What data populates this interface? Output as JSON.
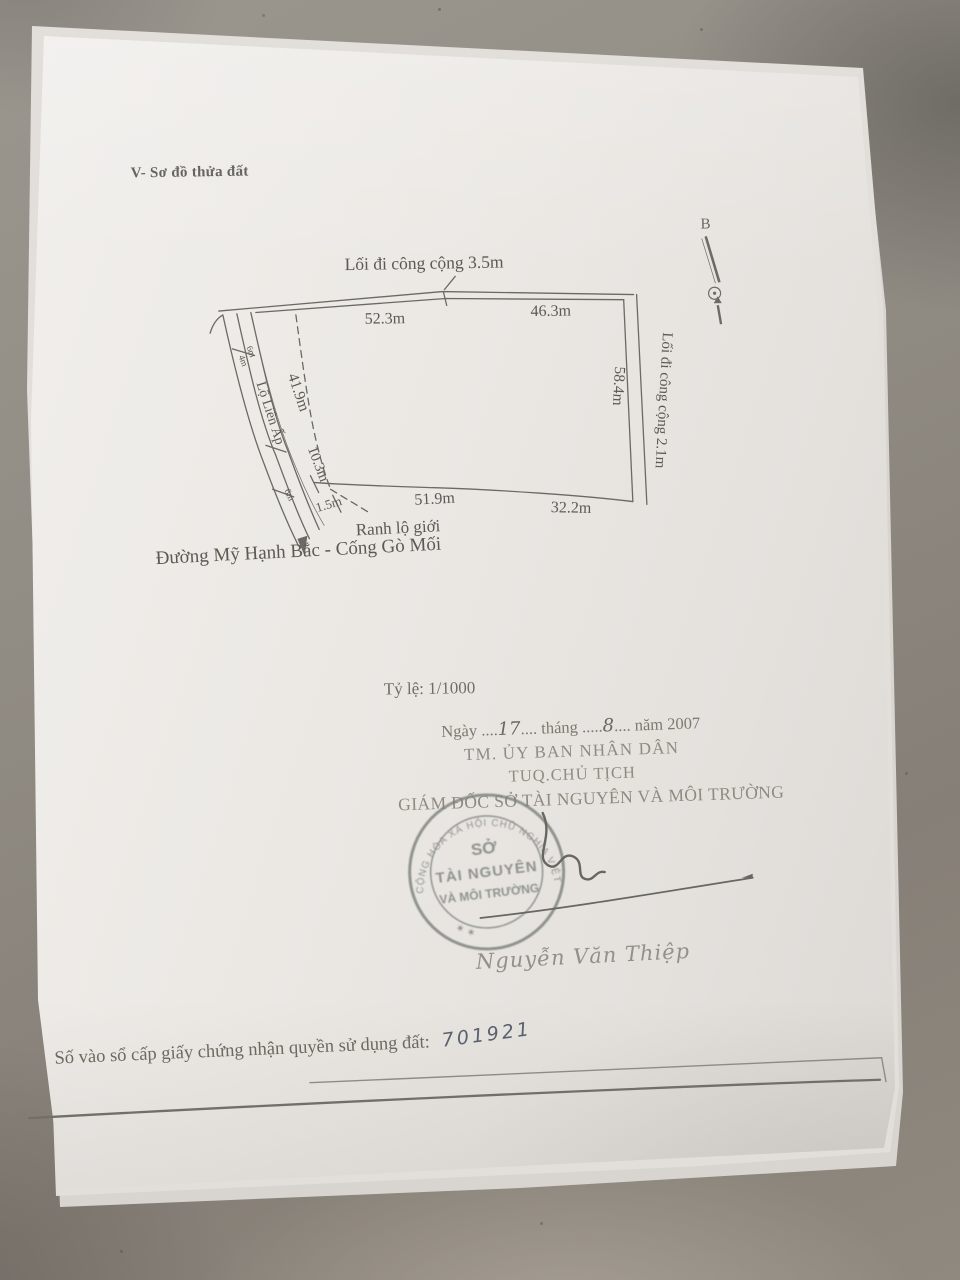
{
  "photo": {
    "surface_color": "#8f8a82",
    "paper_color": "#eae7e3",
    "ink_color": "#5a584f",
    "stamp_color": "#7a7f7a",
    "handwriting_ink_color": "#59606e"
  },
  "page": {
    "section_title": "V- Sơ đồ thửa đất",
    "scale_label": "Tỷ lệ: 1/1000"
  },
  "diagram": {
    "north_label": "B",
    "top_path_label": "Lối đi công cộng 3.5m",
    "right_path_label": "Lối đi công cộng 2.1m",
    "left_road_label": "Lộ Liên Ấp",
    "road_boundary_label": "Ranh lộ giới",
    "street_label": "Đường Mỹ Hạnh Bắc - Cống Gò Mối",
    "dim_top_left": "52.3m",
    "dim_top_right": "46.3m",
    "dim_right": "58.4m",
    "dim_left_upper": "41.9m",
    "dim_left_lower": "10.3m",
    "dim_bottom_small": "1.5m",
    "dim_bottom_left": "51.9m",
    "dim_bottom_right": "32.2m",
    "dim_road_width_a": "6m",
    "dim_road_width_b": "4m",
    "dim_road_width_c": "6m"
  },
  "signature_block": {
    "date_p1": "Ngày ....",
    "date_day": "17",
    "date_p2": ".... tháng .....",
    "date_month": "8",
    "date_p3": ".... năm 2007",
    "authority_line1": "TM. ỦY BAN NHÂN DÂN",
    "authority_line2": "TUQ.CHỦ TỊCH",
    "authority_line3": "GIÁM ĐỐC SỞ TÀI NGUYÊN VÀ MÔI TRƯỜNG",
    "signer_name": "Nguyễn Văn Thiệp"
  },
  "stamp": {
    "ring_text": "CỘNG HÒA XÃ HỘI CHỦ NGHĨA VIỆT NAM",
    "ring_bottom": "✶          ✶",
    "center_line1": "SỞ",
    "center_line2": "TÀI NGUYÊN",
    "center_line3": "VÀ MÔI TRƯỜNG"
  },
  "registry": {
    "label": "Số vào sổ cấp giấy chứng nhận quyền sử dụng đất:",
    "number": "701921"
  }
}
